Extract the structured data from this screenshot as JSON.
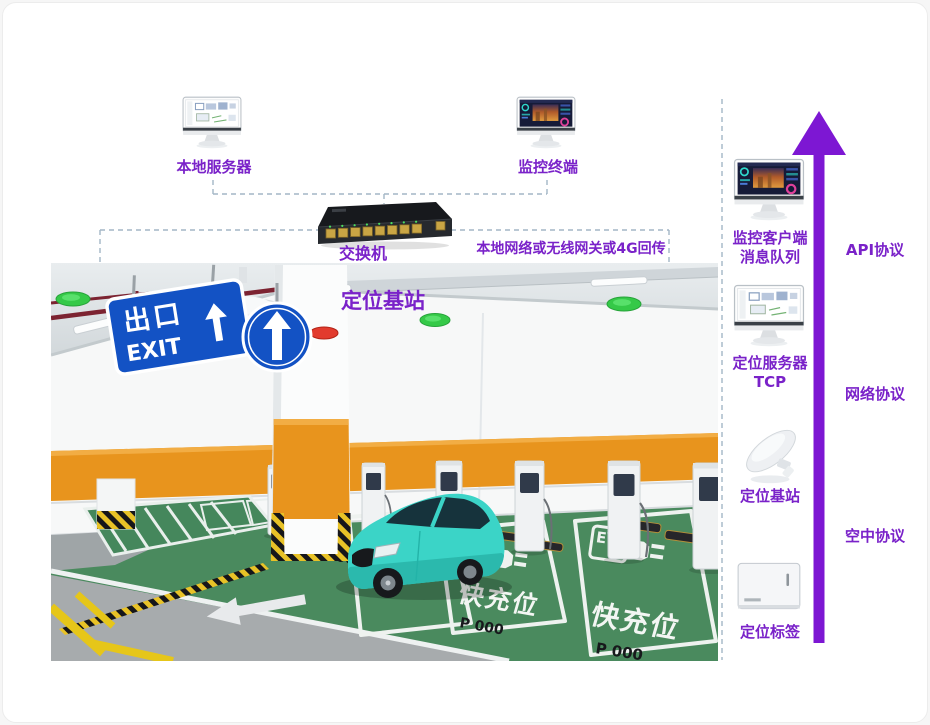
{
  "colors": {
    "accent_purple_text": "#7a22c9",
    "arrow_purple": "#7d17d3",
    "dashed_line": "#a3b6c6",
    "sign_blue": "#1352c4",
    "floor_green": "#4a8a5e",
    "wall_orange": "#e8941d",
    "car_teal": "#3bd4c7"
  },
  "top": {
    "local_server": "本地服务器",
    "monitor_terminal": "监控终端",
    "switch": "交换机",
    "network": "本地网络或无线网关或4G回传"
  },
  "photo": {
    "base_station": "定位基站",
    "exit_cn": "出口",
    "exit_en": "EXIT",
    "fast_charge": "快充位",
    "spot_no": "P 000",
    "ev": "EV"
  },
  "sidebar": {
    "items": [
      {
        "line1": "监控客户端",
        "line2": "消息队列"
      },
      {
        "line1": "定位服务器",
        "line2": "TCP"
      },
      {
        "line1": "定位基站",
        "line2": ""
      },
      {
        "line1": "定位标签",
        "line2": ""
      }
    ],
    "protocols": [
      {
        "label": "API协议"
      },
      {
        "label": "网络协议"
      },
      {
        "label": "空中协议"
      }
    ]
  }
}
